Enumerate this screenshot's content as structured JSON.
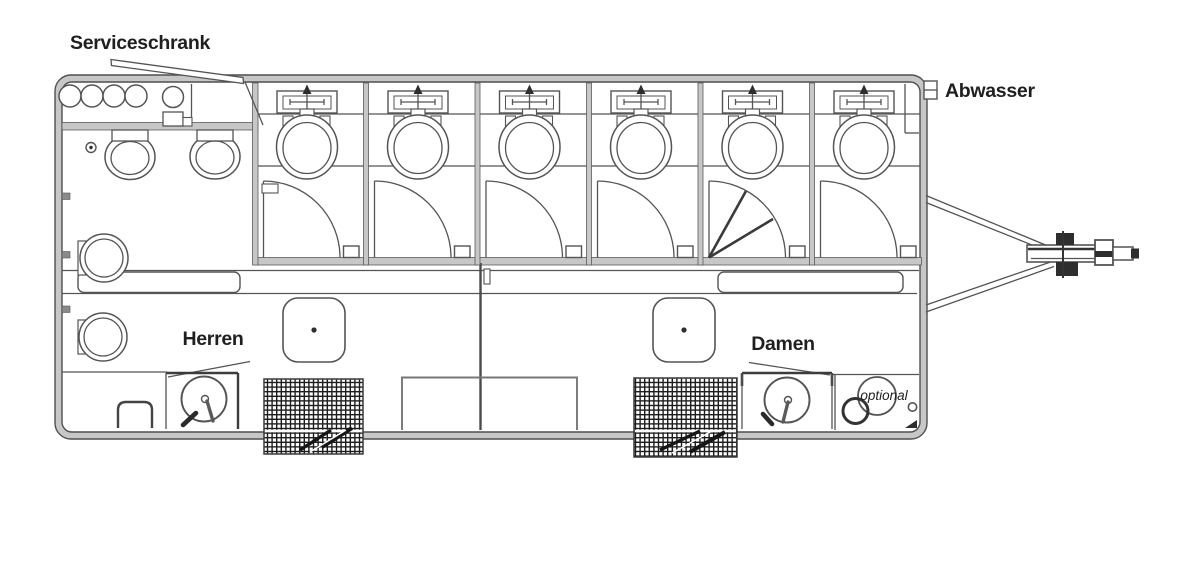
{
  "labels": {
    "service_cabinet": "Serviceschrank",
    "waste_water": "Abwasser",
    "mens_section": "Herren",
    "womens_section": "Damen",
    "optional_fixture": "optional"
  },
  "plan": {
    "type": "toilet-trailer-floor-plan",
    "toilet_cabins": 6,
    "cabin_fixtures": [
      "hand-sink",
      "toilet",
      "inward-swinging-door"
    ],
    "folding_door_cabin": 5,
    "sections": [
      {
        "name": "Serviceschrank",
        "fixtures": [
          "four supply tanks",
          "round tank",
          "switch box",
          "open lid"
        ]
      },
      {
        "name": "Herren",
        "fixtures": [
          "two wall urinals",
          "two round wall basins",
          "washstand with drain",
          "sink unit",
          "entry steps"
        ]
      },
      {
        "name": "Damen",
        "fixtures": [
          "washstand with drain",
          "sink unit",
          "entry steps",
          "optional basin"
        ]
      }
    ],
    "exterior": [
      "waste-water connector",
      "drawbar hitch with coupling"
    ]
  },
  "colors": {
    "background": "#ffffff",
    "line": "#545454",
    "wall_fill": "#c7c7c7",
    "dark_detail": "#2e2e2e",
    "text": "#1f1f1f"
  }
}
